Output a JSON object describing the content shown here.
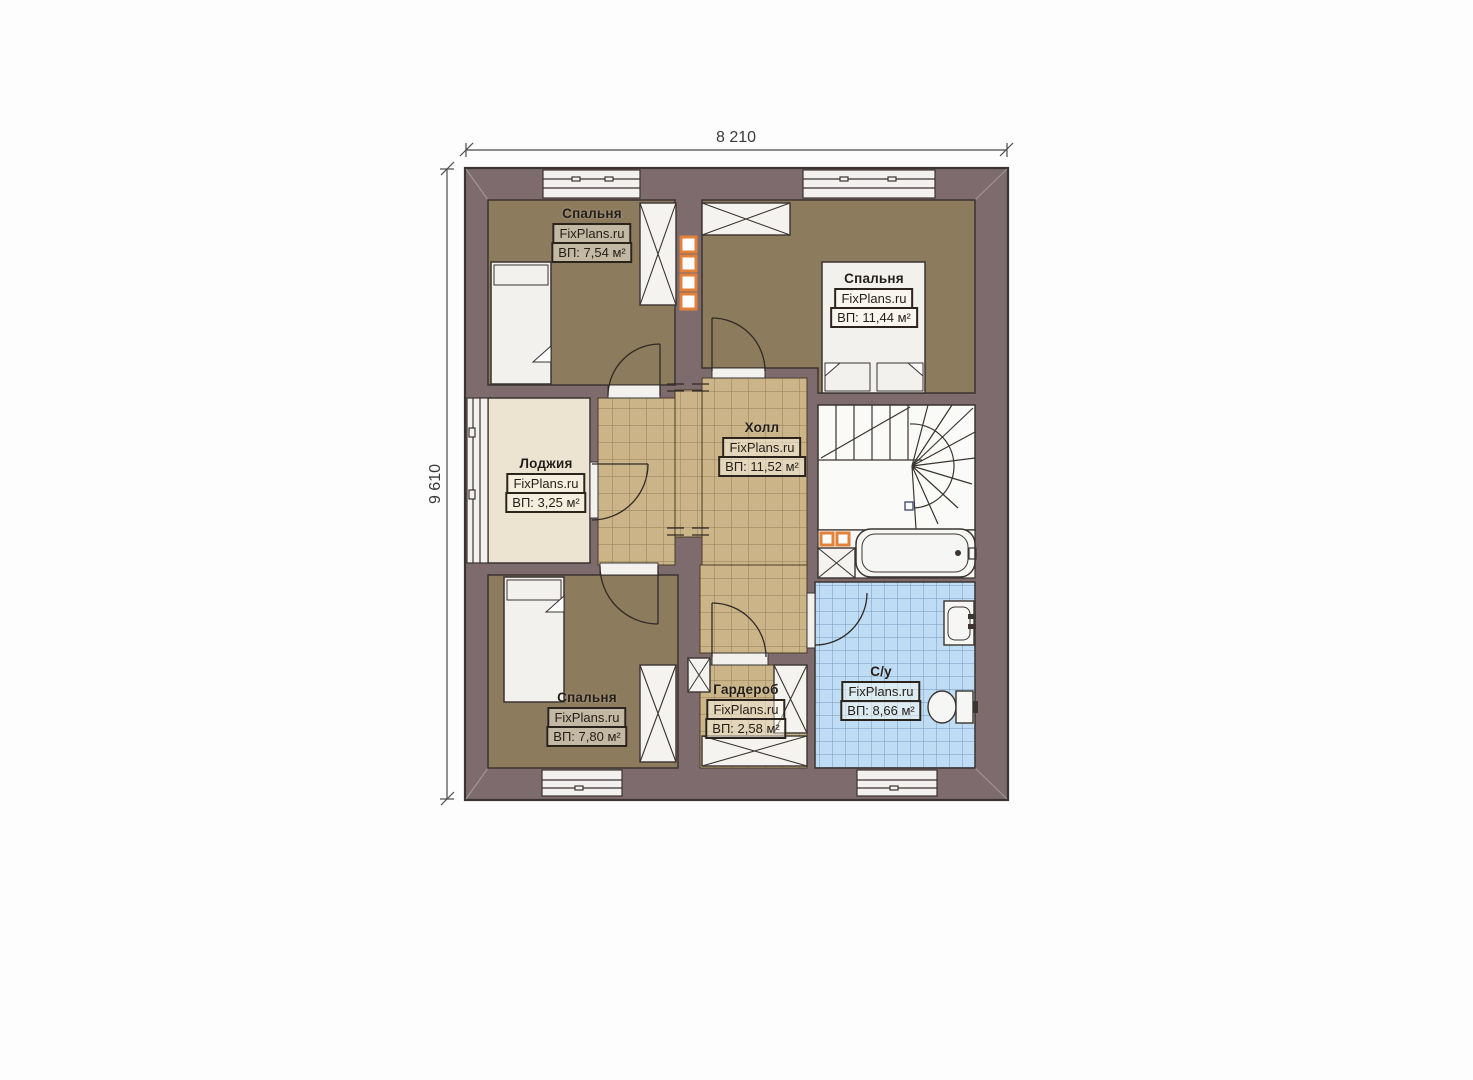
{
  "plan": {
    "dimensions": {
      "width": "8 210",
      "height": "9 610"
    },
    "watermark": "FixPlans.ru",
    "rooms": {
      "bedroom_top_left": {
        "name": "Спальня",
        "brand": "FixPlans.ru",
        "area": "ВП: 7,54 м²"
      },
      "bedroom_top_right": {
        "name": "Спальня",
        "brand": "FixPlans.ru",
        "area": "ВП: 11,44 м²"
      },
      "loggia": {
        "name": "Лоджия",
        "brand": "FixPlans.ru",
        "area": "ВП: 3,25 м²"
      },
      "hall": {
        "name": "Холл",
        "brand": "FixPlans.ru",
        "area": "ВП: 11,52 м²"
      },
      "bedroom_bottom_left": {
        "name": "Спальня",
        "brand": "FixPlans.ru",
        "area": "ВП: 7,80 м²"
      },
      "wardrobe": {
        "name": "Гардероб",
        "brand": "FixPlans.ru",
        "area": "ВП: 2,58 м²"
      },
      "bathroom": {
        "name": "С/у",
        "brand": "FixPlans.ru",
        "area": "ВП: 8,66 м²"
      }
    },
    "colors": {
      "wall": "#7d6b6e",
      "outline": "#3b3430",
      "bedroom_floor": "#8d7b5d",
      "hall_floor": "#cab488",
      "bathroom_floor": "#bedcf4",
      "loggia_floor": "#ece3d0",
      "fixture_white": "#f4f3f0",
      "flue_accent": "#e2813a"
    }
  }
}
